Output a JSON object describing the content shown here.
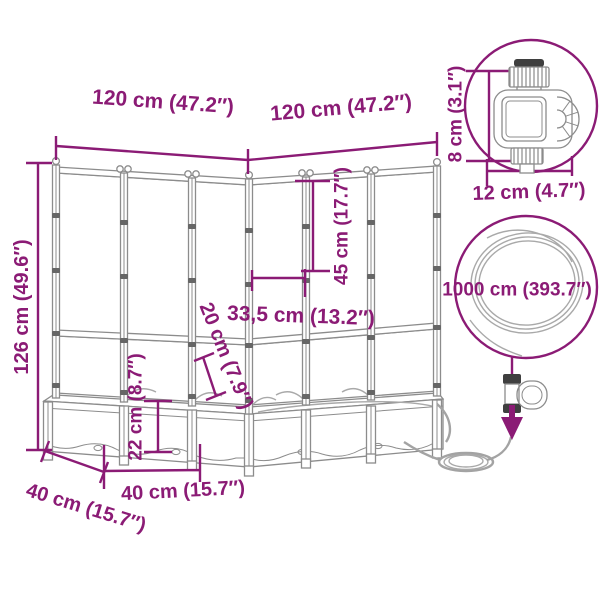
{
  "colors": {
    "accent": "#8b1b75",
    "line": "#8c8c8c",
    "line_dark": "#666666",
    "background": "#ffffff"
  },
  "dimensions": {
    "width_left": "120 cm (47.2″)",
    "width_right": "120 cm (47.2″)",
    "height_total": "126 cm (49.6″)",
    "trellis_height": "45 cm (17.7″)",
    "corner_inner_width": "33,5 cm (13.2″)",
    "rim_depth": "20 cm (7.9″)",
    "box_height": "22 cm (8.7″)",
    "box_depth": "40 cm (15.7″)",
    "box_width": "40 cm (15.7″)",
    "timer_height": "8 cm (3.1″)",
    "timer_width": "12 cm (4.7″)",
    "hose_length": "1000 cm (393.7″)"
  },
  "icons": [
    "water-timer-icon",
    "hose-coil-icon",
    "hose-connector-icon",
    "down-arrow-icon"
  ]
}
